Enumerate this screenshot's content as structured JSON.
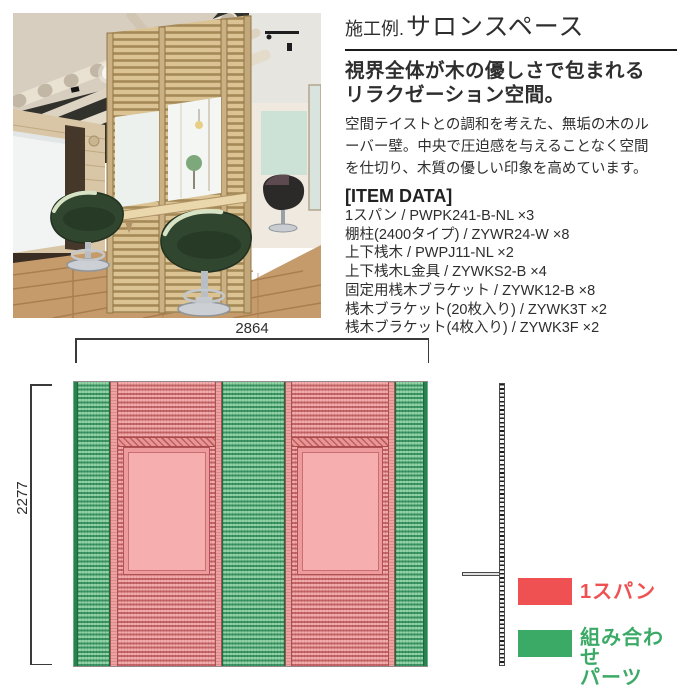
{
  "header": {
    "title_prefix": "施工例.",
    "title": "サロンスペース",
    "subtitle_lines": [
      "視界全体が木の優しさで包まれる",
      "リラクゼーション空間。"
    ],
    "description_lines": [
      "空間テイストとの調和を考えた、無垢の木のル",
      "ーバー壁。中央で圧迫感を与えることなく空間",
      "を仕切り、木質の優しい印象を高めています。"
    ]
  },
  "item_data": {
    "heading": "[ITEM DATA]",
    "items": [
      "1スパン / PWPK241-B-NL ×3",
      "棚柱(2400タイプ) / ZYWR24-W ×8",
      "上下桟木 / PWPJ11-NL ×2",
      "上下桟木L金具 / ZYWKS2-B ×4",
      "固定用桟木ブラケット / ZYWK12-B ×8",
      "桟木ブラケット(20枚入り) / ZYWK3T ×2",
      "桟木ブラケット(4枚入り) / ZYWK3F ×2"
    ]
  },
  "diagram": {
    "width_label": "2864",
    "height_label": "2277",
    "legend": [
      {
        "label": "1スパン",
        "color": "#ef5153"
      },
      {
        "label": "組み合わせパーツ",
        "line1": "組み合わせ",
        "line2": "パーツ",
        "color": "#3caa67"
      }
    ],
    "panel_colors": {
      "span_red": "#ef5153",
      "combo_green": "#3caa67",
      "stripe_light_green": "#90d4a6",
      "stripe_dark_green": "#3c9565",
      "stripe_light_red": "#f5abab",
      "stripe_dark_red": "#c56567",
      "window_pink": "#f6aeaf"
    }
  },
  "photo": {
    "description": "salon-interior-photo"
  }
}
